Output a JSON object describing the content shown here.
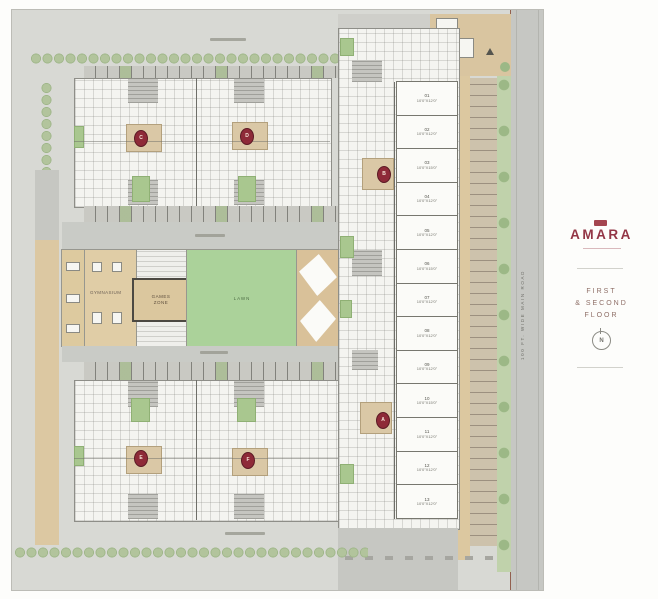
{
  "sidebar": {
    "brand": "AMARA",
    "floor_line1": "FIRST",
    "floor_line2": "& SECOND",
    "floor_line3": "FLOOR",
    "compass_letter": "N",
    "accent_color": "#933646"
  },
  "plan": {
    "road_label": "100 FT. WIDE MAIN ROAD",
    "amenities": {
      "gym_label": "GYMNASIUM",
      "games_label_line1": "GAMES",
      "games_label_line2": "ZONE",
      "lawn_label": "LAWN"
    },
    "cores": [
      {
        "letter": "C"
      },
      {
        "letter": "D"
      },
      {
        "letter": "B"
      },
      {
        "letter": "A"
      },
      {
        "letter": "E"
      },
      {
        "letter": "F"
      }
    ],
    "shops": [
      {
        "num": "01",
        "size": "10'0\"X12'0\""
      },
      {
        "num": "02",
        "size": "10'0\"X12'0\""
      },
      {
        "num": "03",
        "size": "10'0\"X15'0\""
      },
      {
        "num": "04",
        "size": "10'0\"X12'0\""
      },
      {
        "num": "05",
        "size": "10'0\"X12'0\""
      },
      {
        "num": "06",
        "size": "10'0\"X15'0\""
      },
      {
        "num": "07",
        "size": "10'0\"X12'0\""
      },
      {
        "num": "08",
        "size": "10'0\"X12'0\""
      },
      {
        "num": "09",
        "size": "10'0\"X12'0\""
      },
      {
        "num": "10",
        "size": "10'0\"X15'0\""
      },
      {
        "num": "11",
        "size": "10'0\"X12'0\""
      },
      {
        "num": "12",
        "size": "10'0\"X12'0\""
      },
      {
        "num": "13",
        "size": "10'0\"X12'0\""
      }
    ],
    "colors": {
      "lawn": "#abd29a",
      "paving_tan": "#dcc8a2",
      "core_maroon": "#8e2a38",
      "tree_green": "#b2c49c"
    }
  }
}
